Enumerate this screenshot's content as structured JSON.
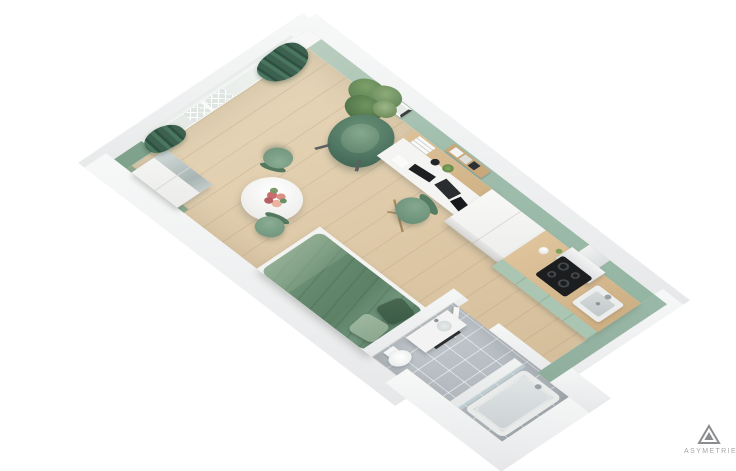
{
  "branding": {
    "logo_text": "ASYMETRIE"
  },
  "scene": {
    "type": "3d-floor-plan-render",
    "subject": "studio-apartment-top-view",
    "areas": [
      "living-sleeping-area",
      "dining-area",
      "desk-area",
      "kitchenette",
      "bathroom",
      "window-balcony-wall"
    ],
    "palette": {
      "background": "#ffffff",
      "wall_white": "#f1f2f2",
      "wall_green": "#9cbaa8",
      "wall_green_dark_accent": "#7fa28c",
      "floor_wood": "#dcc6a4",
      "bathroom_tile": "#b3b9be",
      "curtain_green": "#3c6150",
      "bed_green": "#64886e",
      "pillow_dark_green": "#3b5a47",
      "pillow_light_green": "#93ae96",
      "chair_green": "#6b9078",
      "kitchen_cabinet_green": "#aac6b3",
      "counter_wood": "#d5b88e",
      "cooktop_black": "#1b1d1f",
      "logo_grey": "#a3a6a9"
    },
    "objects": [
      "window-with-railing",
      "curtains",
      "potted-plant",
      "lounge-armchair",
      "picture-frame",
      "wall-shelf-with-books",
      "desk-with-laptop-keyboard-lamp",
      "desk-chair",
      "tall-white-storage-units",
      "kitchen-counter",
      "range-hood",
      "induction-cooktop",
      "kitchen-sink",
      "round-dining-table-with-flowers",
      "dining-chairs",
      "double-bed-green-bedding",
      "wardrobe-with-mirror",
      "bathroom-vanity-sink",
      "toilet",
      "bathtub-shower",
      "bathroom-door"
    ]
  }
}
